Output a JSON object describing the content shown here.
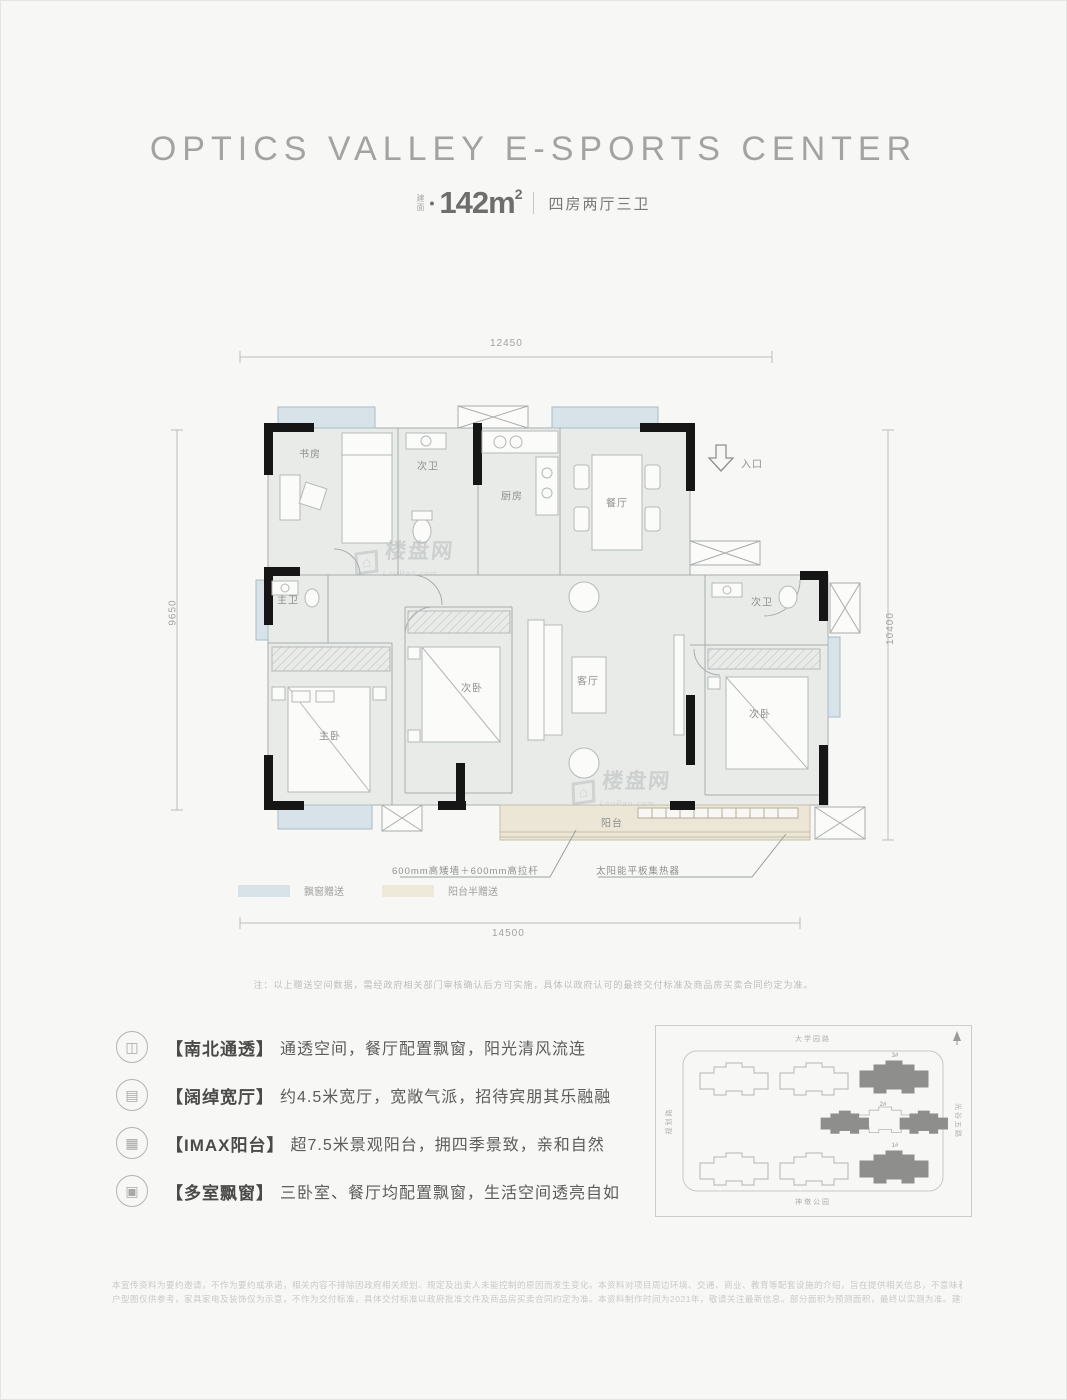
{
  "header": {
    "title": "OPTICS VALLEY E-SPORTS CENTER",
    "area_label_top": "建",
    "area_label_bottom": "面",
    "bullet": "•",
    "area_value": "142m",
    "area_exp": "2",
    "layout_text": "四房两厅三卫"
  },
  "floorplan": {
    "dims": {
      "top": "12450",
      "left": "9650",
      "right": "10400",
      "bottom": "14500"
    },
    "rooms": [
      {
        "label": "书房"
      },
      {
        "label": "次卫"
      },
      {
        "label": "厨房"
      },
      {
        "label": "餐厅"
      },
      {
        "label": "入口"
      },
      {
        "label": "主卫"
      },
      {
        "label": "主卧"
      },
      {
        "label": "次卧"
      },
      {
        "label": "客厅"
      },
      {
        "label": "次卫"
      },
      {
        "label": "次卧"
      },
      {
        "label": "阳台"
      }
    ],
    "annotations": [
      {
        "text": "600mm高矮墙＋600mm高拉杆"
      },
      {
        "text": "太阳能平板集热器"
      }
    ],
    "legend": [
      {
        "label": "飘窗赠送",
        "color": "#d7e3e9"
      },
      {
        "label": "阳台半赠送",
        "color": "#efe9d9"
      }
    ],
    "note": "注：以上赠送空间数据，需经政府相关部门审核确认后方可实施，具体以政府认可的最终交付标准及商品房买卖合同约定为准。"
  },
  "features": [
    {
      "icon_name": "north-south-ventilation-icon",
      "glyph": "◫",
      "tag": "【南北通透】",
      "desc": "通透空间，餐厅配置飘窗，阳光清风流连"
    },
    {
      "icon_name": "wide-living-hall-icon",
      "glyph": "▤",
      "tag": "【阔绰宽厅】",
      "desc": "约4.5米宽厅，宽敞气派，招待宾朋其乐融融"
    },
    {
      "icon_name": "imax-balcony-icon",
      "glyph": "▦",
      "tag": "【IMAX阳台】",
      "desc": "超7.5米景观阳台，拥四季景致，亲和自然"
    },
    {
      "icon_name": "multi-bay-window-icon",
      "glyph": "▣",
      "tag": "【多室飘窗】",
      "desc": "三卧室、餐厅均配置飘窗，生活空间透亮自如"
    }
  ],
  "siteplan": {
    "roads": {
      "top": "大学园路",
      "bottom": "神墩公园",
      "left": "规划路",
      "right": "光谷五路"
    },
    "buildings": [
      {
        "label": "3#"
      },
      {
        "label": "2#"
      },
      {
        "label": "1#"
      }
    ]
  },
  "watermark": {
    "logo": "⌂",
    "name": "楼盘网",
    "sub": "LouPan.com"
  },
  "disclaimer": {
    "line1": "本宣传资料为要约邀请，不作为要约或承诺，相关内容不排除因政府相关规划、规定及出卖人未能控制的原因而发生变化。本资料对项目周边环境、交通、商业、教育等配套设施的介绍，旨在提供相关信息，不意味着本公司对此作出承诺。",
    "line2": "户型图仅供参考，家具家电及装饰仅为示意，不作为交付标准，具体交付标准以政府批准文件及商品房买卖合同约定为准。本资料制作时间为2021年，敬请关注最新信息。部分面积为预测面积，最终以实测为准。建筑面积约142㎡。"
  }
}
